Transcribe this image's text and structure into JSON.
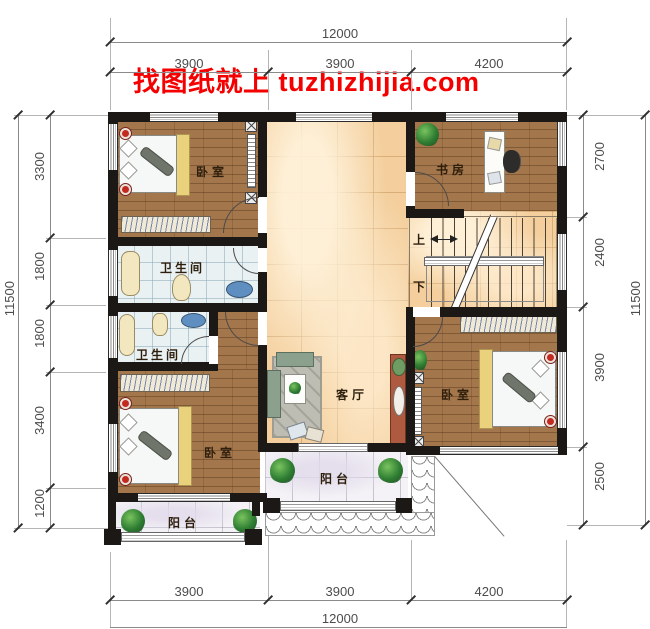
{
  "watermark": {
    "text": "找图纸就上 tuzhizhijia.com"
  },
  "rooms": {
    "bedroom_top_left": "卧室",
    "study": "书房",
    "bathroom_upper": "卫生间",
    "bathroom_lower": "卫生间",
    "living_room": "客厅",
    "bedroom_bottom_left": "卧室",
    "bedroom_right": "卧室",
    "balcony_center": "阳台",
    "balcony_bottom_left": "阳台",
    "stair_up": "上",
    "stair_down": "下"
  },
  "dimensions": {
    "top": {
      "total": "12000",
      "segments": [
        "3900",
        "3900",
        "4200"
      ]
    },
    "bottom": {
      "total": "12000",
      "segments": [
        "3900",
        "3900",
        "4200"
      ]
    },
    "left": {
      "total": "11500",
      "segments": [
        "3300",
        "1800",
        "1800",
        "3400",
        "1200"
      ]
    },
    "right": {
      "total": "11500",
      "segments": [
        "2700",
        "2400",
        "3900",
        "2500"
      ]
    }
  },
  "colors": {
    "watermark_red": "#f40000",
    "wall_black": "#1b1815",
    "wood_floor": "#a4764b",
    "hall_tile": "#f4cf9d",
    "bath_tile": "#eaf1f3",
    "balcony_tile": "#f4f2f6"
  }
}
